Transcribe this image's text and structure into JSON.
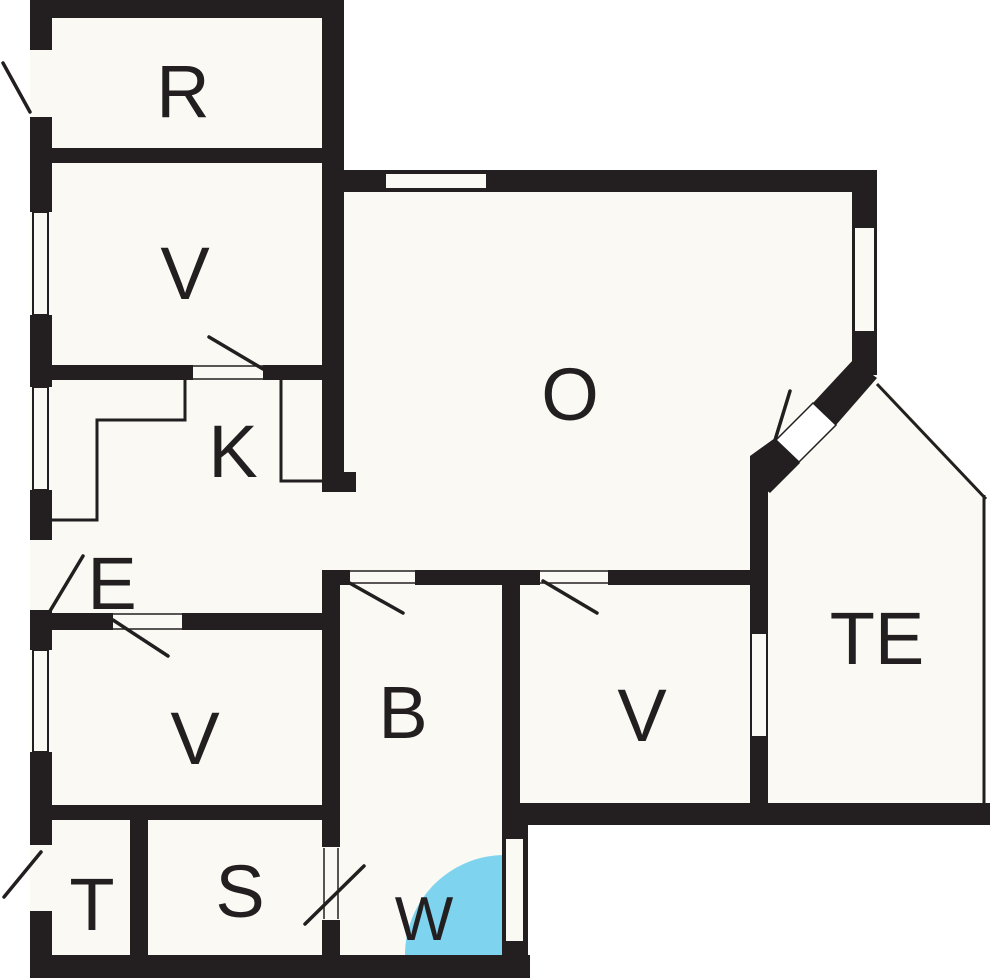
{
  "title": "Floor plan",
  "colors": {
    "wall": "#231f20",
    "floor": "#faf9f3",
    "outside": "#ffffff",
    "shower": "#7ed3ee"
  },
  "rooms": [
    {
      "id": "room-r",
      "label": "R"
    },
    {
      "id": "room-v-upper",
      "label": "V"
    },
    {
      "id": "room-k",
      "label": "K"
    },
    {
      "id": "room-e",
      "label": "E"
    },
    {
      "id": "room-o",
      "label": "O"
    },
    {
      "id": "room-te",
      "label": "TE"
    },
    {
      "id": "room-v-lower-left",
      "label": "V"
    },
    {
      "id": "room-b",
      "label": "B"
    },
    {
      "id": "room-v-lower-right",
      "label": "V"
    },
    {
      "id": "room-t",
      "label": "T"
    },
    {
      "id": "room-s",
      "label": "S"
    },
    {
      "id": "room-w",
      "label": "W"
    }
  ]
}
